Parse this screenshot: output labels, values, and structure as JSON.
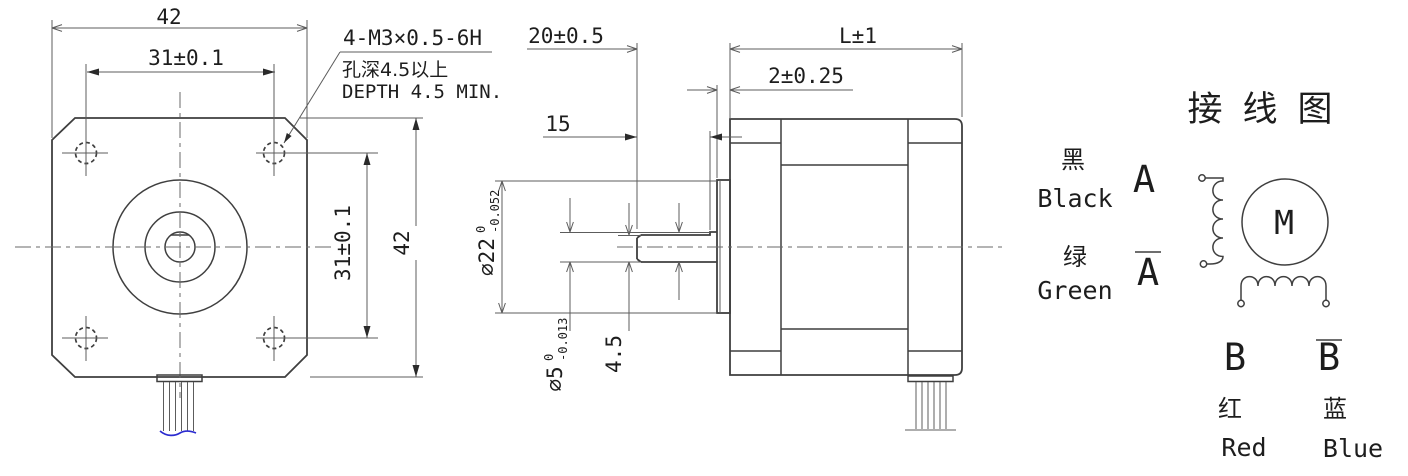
{
  "front_view": {
    "dims": {
      "width_top": "42",
      "hole_spacing_top": "31±0.1",
      "hole_spacing_right": "31±0.1",
      "height_right": "42"
    },
    "note": {
      "line1": "4-M3×0.5-6H",
      "line2": "孔深4.5以上",
      "line3": "DEPTH 4.5 MIN."
    }
  },
  "side_view": {
    "dims": {
      "shaft_length": "20±0.5",
      "body_length": "L±1",
      "pilot_depth": "2±0.25",
      "flat_length": "15",
      "pilot_dia": "∅22",
      "pilot_dia_tol_upper": "0",
      "pilot_dia_tol_lower": "-0.052",
      "shaft_dia": "∅5",
      "shaft_dia_tol_upper": "0",
      "shaft_dia_tol_lower": "-0.013",
      "flat_height": "4.5"
    }
  },
  "wiring_diagram": {
    "title": "接线图",
    "motor_label": "M",
    "leads": {
      "a": {
        "phase": "A",
        "color_cn": "黑",
        "color_en": "Black"
      },
      "a_bar": {
        "phase": "A",
        "color_cn": "绿",
        "color_en": "Green"
      },
      "b": {
        "phase": "B",
        "color_cn": "红",
        "color_en": "Red"
      },
      "b_bar": {
        "phase": "B",
        "color_cn": "蓝",
        "color_en": "Blue"
      }
    }
  },
  "colors": {
    "object_line": "#3f3f3f",
    "dimension_line": "#5c5c5c",
    "text": "#1d1d1d",
    "wire_break_line": "#2b2bd0"
  }
}
